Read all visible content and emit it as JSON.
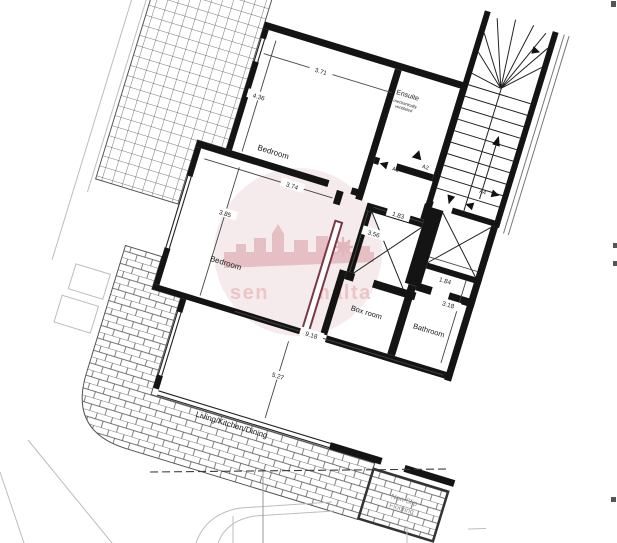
{
  "rooms": {
    "bedroom1": "Bedroom",
    "bedroom2": "Bedroom",
    "ensuite": "Ensuite",
    "boxroom": "Box room",
    "bathroom": "Bathroom",
    "living": "Living/Kitchen/Dining"
  },
  "notes": {
    "ensuite_note_line1": "mechanically",
    "ensuite_note_line2": "ventilated",
    "balcony_note_line1": "Non-Slip",
    "balcony_note_line2": "Flooring"
  },
  "dimensions": {
    "bedroom1_width": "3.71",
    "bedroom1_depth": "4.36",
    "bedroom2_width": "3.74",
    "bedroom2_depth": "3.85",
    "shaft1_width": "1.83",
    "shaft1_depth": "3.56",
    "shaft2_width": "1.84",
    "bathroom_depth": "3.18",
    "living_width": "9.18",
    "living_depth": "5.27"
  },
  "door_markers": {
    "a2": "A2",
    "a3": "A3",
    "a4": "A4"
  },
  "watermark": {
    "left": "sen",
    "right": "malta"
  },
  "colors": {
    "wall": "#141414",
    "highlight_wall": "#7a3844",
    "hatch_line": "#4a4a4a",
    "site_line": "#bdbdbd",
    "dash_line": "#3c3c3c",
    "note_grey": "#8a8a8a",
    "watermark_fill": "#f6ebec",
    "watermark_accent": "#e5bfc3",
    "watermark_text": "#ecc5c8"
  }
}
